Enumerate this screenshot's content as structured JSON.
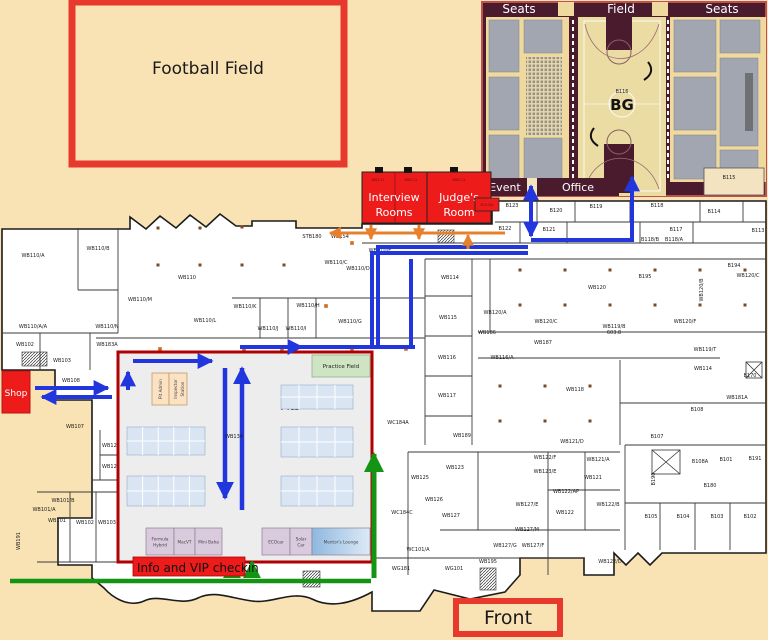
{
  "colors": {
    "background": "#F9E2B3",
    "wall": "#2a2a2a",
    "highlight_red": "#EE1B1B",
    "border_red": "#E8392F",
    "route_blue": "#2236DE",
    "route_orange": "#E8802B",
    "route_green": "#149414",
    "gym_maroon": "#4A1B2D",
    "gym_court": "#EBDCA4",
    "gym_seating": "#EFD99E",
    "seat_gray": "#A2A6B0",
    "pits_fill": "#EDEDED",
    "pits_border": "#B00000",
    "table_blue": "#D9E5F3",
    "zone_mauve": "#D9CBDD",
    "zone_blue": "#9DC3E6",
    "marker_orange": "#D2691E",
    "column_brown": "#7B4A22"
  },
  "outdoor": {
    "football_field": "Football Field",
    "front": "Front",
    "shop": "Shop"
  },
  "gym": {
    "headers": [
      "Seats",
      "Field",
      "Seats"
    ],
    "event": "Event",
    "office": "Office",
    "court_number": "B116",
    "logo": "BG",
    "corner_room": "B115",
    "seat_blocks": [
      [
        489,
        20,
        30,
        52
      ],
      [
        489,
        77,
        30,
        53
      ],
      [
        489,
        135,
        30,
        44
      ],
      [
        524,
        20,
        38,
        33
      ],
      [
        524,
        138,
        38,
        41
      ],
      [
        674,
        20,
        42,
        52
      ],
      [
        674,
        77,
        42,
        53
      ],
      [
        674,
        135,
        42,
        44
      ],
      [
        720,
        20,
        40,
        33
      ],
      [
        720,
        58,
        38,
        88
      ],
      [
        720,
        150,
        38,
        29
      ]
    ],
    "dark_block": [
      745,
      73,
      8,
      58
    ]
  },
  "event_rooms": {
    "interview_line1": "Interview",
    "interview_line2": "Rooms",
    "judges_line1": "Judge's",
    "judges_line2": "Room",
    "numbers": [
      "WB111",
      "WB112",
      "WB113"
    ],
    "b123a": "B123/A"
  },
  "pits": {
    "title": "Pits",
    "practice_field": "Practice Field",
    "pit_admin": "Pit Admin",
    "inspector_line1": "Inspector",
    "inspector_line2": "Station",
    "center_room": "WB134",
    "checkin": "Info and VIP checkin",
    "team_zones": [
      {
        "label": "Formula Hybrid",
        "lines": [
          "Formula",
          "Hybrid"
        ],
        "x": 146,
        "w": 28,
        "style": "mauve"
      },
      {
        "label": "MacVT",
        "lines": [
          "MacVT"
        ],
        "x": 174,
        "w": 21,
        "style": "mauve"
      },
      {
        "label": "Mini Baha",
        "lines": [
          "Mini Baha"
        ],
        "x": 195,
        "w": 27,
        "style": "mauve"
      },
      {
        "label": "ECOcar",
        "lines": [
          "ECOcar"
        ],
        "x": 262,
        "w": 28,
        "style": "mauve"
      },
      {
        "label": "Solar Car",
        "lines": [
          "Solar",
          "Car"
        ],
        "x": 290,
        "w": 22,
        "style": "mauve"
      },
      {
        "label": "Mentor's Lounge",
        "lines": [
          "Mentor's Lounge"
        ],
        "x": 312,
        "w": 58,
        "style": "blue"
      }
    ],
    "table_clusters": [
      {
        "x": 127,
        "y": 427,
        "w": 78,
        "h": 28,
        "cols": 5,
        "rows": 2
      },
      {
        "x": 127,
        "y": 476,
        "w": 78,
        "h": 30,
        "cols": 5,
        "rows": 2
      },
      {
        "x": 281,
        "y": 385,
        "w": 72,
        "h": 24,
        "cols": 4,
        "rows": 2
      },
      {
        "x": 281,
        "y": 427,
        "w": 72,
        "h": 30,
        "cols": 4,
        "rows": 2
      },
      {
        "x": 281,
        "y": 476,
        "w": 72,
        "h": 30,
        "cols": 4,
        "rows": 2
      }
    ]
  },
  "floorplan": {
    "room_labels": [
      {
        "x": 33,
        "y": 257,
        "t": "WB110/A"
      },
      {
        "x": 98,
        "y": 250,
        "t": "WB110/B"
      },
      {
        "x": 187,
        "y": 279,
        "t": "WB110"
      },
      {
        "x": 140,
        "y": 301,
        "t": "WB110/M"
      },
      {
        "x": 205,
        "y": 322,
        "t": "WB110/L"
      },
      {
        "x": 107,
        "y": 328,
        "t": "WB110/N"
      },
      {
        "x": 33,
        "y": 328,
        "t": "WB110/A/A"
      },
      {
        "x": 312,
        "y": 238,
        "t": "STB180"
      },
      {
        "x": 340,
        "y": 238,
        "t": "WB154"
      },
      {
        "x": 336,
        "y": 264,
        "t": "WB110/C"
      },
      {
        "x": 358,
        "y": 270,
        "t": "WB110/D"
      },
      {
        "x": 380,
        "y": 252,
        "t": "WB110/E"
      },
      {
        "x": 245,
        "y": 308,
        "t": "WB110/K"
      },
      {
        "x": 308,
        "y": 307,
        "t": "WB110/H"
      },
      {
        "x": 268,
        "y": 330,
        "t": "WB110/J"
      },
      {
        "x": 296,
        "y": 330,
        "t": "WB110/I"
      },
      {
        "x": 350,
        "y": 323,
        "t": "WB110/G"
      },
      {
        "x": 419,
        "y": 249,
        "t": "WB185"
      },
      {
        "x": 450,
        "y": 279,
        "t": "WB114"
      },
      {
        "x": 448,
        "y": 319,
        "t": "WB115"
      },
      {
        "x": 447,
        "y": 359,
        "t": "WB116"
      },
      {
        "x": 447,
        "y": 397,
        "t": "WB117"
      },
      {
        "x": 512,
        "y": 207,
        "t": "B123"
      },
      {
        "x": 556,
        "y": 212,
        "t": "B120"
      },
      {
        "x": 596,
        "y": 208,
        "t": "B119"
      },
      {
        "x": 657,
        "y": 207,
        "t": "B118"
      },
      {
        "x": 714,
        "y": 213,
        "t": "B114"
      },
      {
        "x": 758,
        "y": 232,
        "t": "B113"
      },
      {
        "x": 505,
        "y": 230,
        "t": "B122"
      },
      {
        "x": 549,
        "y": 231,
        "t": "B121"
      },
      {
        "x": 676,
        "y": 231,
        "t": "B117"
      },
      {
        "x": 650,
        "y": 241,
        "t": "B118/B"
      },
      {
        "x": 674,
        "y": 241,
        "t": "B118/A"
      },
      {
        "x": 734,
        "y": 267,
        "t": "B194"
      },
      {
        "x": 645,
        "y": 278,
        "t": "B195"
      },
      {
        "x": 597,
        "y": 289,
        "t": "WB120"
      },
      {
        "x": 748,
        "y": 277,
        "t": "WB120/C"
      },
      {
        "x": 703,
        "y": 290,
        "t": "WB120/B",
        "v": 1
      },
      {
        "x": 495,
        "y": 314,
        "t": "WB120/A"
      },
      {
        "x": 546,
        "y": 323,
        "t": "WB120/C"
      },
      {
        "x": 614,
        "y": 328,
        "t": "WB119/B"
      },
      {
        "x": 614,
        "y": 334,
        "t": "603.8"
      },
      {
        "x": 685,
        "y": 323,
        "t": "WB120/F"
      },
      {
        "x": 487,
        "y": 334,
        "t": "WB186"
      },
      {
        "x": 543,
        "y": 344,
        "t": "WB187"
      },
      {
        "x": 705,
        "y": 351,
        "t": "WB119/T"
      },
      {
        "x": 502,
        "y": 359,
        "t": "WB116/A"
      },
      {
        "x": 703,
        "y": 370,
        "t": "WB114"
      },
      {
        "x": 575,
        "y": 391,
        "t": "WB118"
      },
      {
        "x": 737,
        "y": 399,
        "t": "WB181A"
      },
      {
        "x": 697,
        "y": 411,
        "t": "B108"
      },
      {
        "x": 657,
        "y": 438,
        "t": "B107"
      },
      {
        "x": 750,
        "y": 377,
        "t": "B170"
      },
      {
        "x": 367,
        "y": 393,
        "t": "WB105",
        "v": 1
      },
      {
        "x": 398,
        "y": 424,
        "t": "WC184A"
      },
      {
        "x": 462,
        "y": 437,
        "t": "WB189"
      },
      {
        "x": 572,
        "y": 443,
        "t": "WB121/D"
      },
      {
        "x": 455,
        "y": 469,
        "t": "WB123"
      },
      {
        "x": 420,
        "y": 479,
        "t": "WB125"
      },
      {
        "x": 434,
        "y": 501,
        "t": "WB126"
      },
      {
        "x": 451,
        "y": 517,
        "t": "WB127"
      },
      {
        "x": 545,
        "y": 459,
        "t": "WB122/F"
      },
      {
        "x": 545,
        "y": 473,
        "t": "WB123/E"
      },
      {
        "x": 598,
        "y": 461,
        "t": "WB121/A"
      },
      {
        "x": 593,
        "y": 479,
        "t": "WB121"
      },
      {
        "x": 566,
        "y": 493,
        "t": "WB122/AP"
      },
      {
        "x": 527,
        "y": 506,
        "t": "WB127/E"
      },
      {
        "x": 565,
        "y": 514,
        "t": "WB122"
      },
      {
        "x": 608,
        "y": 506,
        "t": "WB122/B"
      },
      {
        "x": 527,
        "y": 531,
        "t": "WB127/M"
      },
      {
        "x": 505,
        "y": 547,
        "t": "WB127/G"
      },
      {
        "x": 533,
        "y": 547,
        "t": "WB127/F"
      },
      {
        "x": 610,
        "y": 563,
        "t": "WB122/D"
      },
      {
        "x": 418,
        "y": 551,
        "t": "WC101/A"
      },
      {
        "x": 488,
        "y": 563,
        "t": "WB195"
      },
      {
        "x": 454,
        "y": 570,
        "t": "WG101"
      },
      {
        "x": 402,
        "y": 514,
        "t": "WC184C"
      },
      {
        "x": 401,
        "y": 570,
        "t": "WG181"
      },
      {
        "x": 700,
        "y": 463,
        "t": "B108A"
      },
      {
        "x": 726,
        "y": 461,
        "t": "B101"
      },
      {
        "x": 755,
        "y": 460,
        "t": "B191"
      },
      {
        "x": 655,
        "y": 479,
        "t": "B190",
        "v": 1
      },
      {
        "x": 710,
        "y": 487,
        "t": "B180"
      },
      {
        "x": 651,
        "y": 518,
        "t": "B105"
      },
      {
        "x": 683,
        "y": 518,
        "t": "B104"
      },
      {
        "x": 717,
        "y": 518,
        "t": "B103"
      },
      {
        "x": 750,
        "y": 518,
        "t": "B102"
      },
      {
        "x": 25,
        "y": 346,
        "t": "WB102"
      },
      {
        "x": 107,
        "y": 346,
        "t": "WB183A"
      },
      {
        "x": 62,
        "y": 362,
        "t": "WB103"
      },
      {
        "x": 71,
        "y": 382,
        "t": "WB108"
      },
      {
        "x": 75,
        "y": 428,
        "t": "WB107"
      },
      {
        "x": 111,
        "y": 447,
        "t": "WB128"
      },
      {
        "x": 111,
        "y": 468,
        "t": "WB125"
      },
      {
        "x": 63,
        "y": 502,
        "t": "WB101/B"
      },
      {
        "x": 44,
        "y": 511,
        "t": "WB101/A"
      },
      {
        "x": 57,
        "y": 522,
        "t": "WB101"
      },
      {
        "x": 85,
        "y": 524,
        "t": "WB102"
      },
      {
        "x": 107,
        "y": 524,
        "t": "WB103"
      },
      {
        "x": 20,
        "y": 541,
        "t": "WB191",
        "v": 1
      }
    ],
    "orange_markers": [
      [
        160,
        349
      ],
      [
        244,
        349
      ],
      [
        282,
        349
      ],
      [
        352,
        349
      ],
      [
        406,
        349
      ],
      [
        352,
        243
      ],
      [
        326,
        306
      ],
      [
        128,
        419
      ]
    ],
    "column_dots": [
      [
        520,
        270
      ],
      [
        565,
        270
      ],
      [
        610,
        270
      ],
      [
        655,
        270
      ],
      [
        700,
        270
      ],
      [
        745,
        270
      ],
      [
        520,
        305
      ],
      [
        565,
        305
      ],
      [
        610,
        305
      ],
      [
        655,
        305
      ],
      [
        700,
        305
      ],
      [
        745,
        305
      ],
      [
        500,
        386
      ],
      [
        545,
        386
      ],
      [
        590,
        386
      ],
      [
        500,
        421
      ],
      [
        545,
        421
      ],
      [
        590,
        421
      ],
      [
        158,
        228
      ],
      [
        200,
        228
      ],
      [
        242,
        227
      ],
      [
        158,
        265
      ],
      [
        200,
        265
      ],
      [
        242,
        265
      ],
      [
        284,
        265
      ]
    ]
  }
}
